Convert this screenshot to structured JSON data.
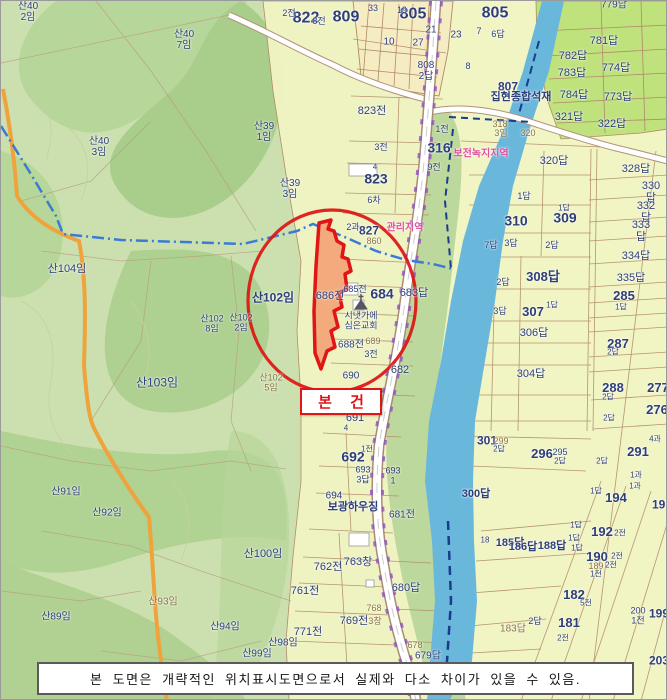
{
  "subject_box": {
    "label": "본 건"
  },
  "disclaimer": {
    "text": "본 도면은 개략적인 위치표시도면으로서 실제와 다소 차이가 있을 수 있음."
  },
  "landmarks": {
    "church": "시냇가에 심은교회",
    "business_1": "집현종합석재",
    "business_2": "보광하우징"
  },
  "zones": [
    "보전녹지지역",
    "관리지역"
  ],
  "subject_parcel": "686전",
  "colors": {
    "forest_light": "#cbe0ae",
    "forest_dark": "#abcf8d",
    "farmland": "#f1f4c3",
    "paddy_green": "#bfe27d",
    "cream": "#f6ecc2",
    "river": "#6ab7dc",
    "boundary": "#b08a68",
    "road_orange": "#efa33c",
    "label_navy": "#2e3f78",
    "label_olive": "#8a7440",
    "zone_pink": "#e0509f",
    "highlight_red": "#e01515",
    "subject_fill": "#f2a579"
  },
  "labels": [
    {
      "x": 27,
      "y": 12,
      "t": "산40\n2임",
      "c": "n",
      "s": 10
    },
    {
      "x": 305,
      "y": 17,
      "t": "822",
      "c": "b",
      "s": 16
    },
    {
      "x": 288,
      "y": 13,
      "t": "2전",
      "c": "n",
      "s": 9
    },
    {
      "x": 183,
      "y": 40,
      "t": "산40\n7임",
      "c": "n",
      "s": 10
    },
    {
      "x": 98,
      "y": 147,
      "t": "산40\n3임",
      "c": "n",
      "s": 10
    },
    {
      "x": 263,
      "y": 132,
      "t": "산39\n1임",
      "c": "n",
      "s": 10
    },
    {
      "x": 289,
      "y": 189,
      "t": "산39\n3임",
      "c": "n",
      "s": 10
    },
    {
      "x": 345,
      "y": 16,
      "t": "809",
      "c": "b",
      "s": 16
    },
    {
      "x": 372,
      "y": 8,
      "t": "33",
      "c": "n",
      "s": 9
    },
    {
      "x": 318,
      "y": 21,
      "t": "8전",
      "c": "n",
      "s": 9
    },
    {
      "x": 412,
      "y": 13,
      "t": "805",
      "c": "b",
      "s": 16
    },
    {
      "x": 494,
      "y": 12,
      "t": "805",
      "c": "b",
      "s": 16
    },
    {
      "x": 401,
      "y": 10,
      "t": "19",
      "c": "n",
      "s": 9
    },
    {
      "x": 430,
      "y": 30,
      "t": "21",
      "c": "n",
      "s": 10
    },
    {
      "x": 388,
      "y": 42,
      "t": "10",
      "c": "n",
      "s": 10
    },
    {
      "x": 417,
      "y": 43,
      "t": "27",
      "c": "n",
      "s": 10
    },
    {
      "x": 455,
      "y": 35,
      "t": "23",
      "c": "n",
      "s": 10
    },
    {
      "x": 425,
      "y": 71,
      "t": "808\n2답",
      "c": "n",
      "s": 10
    },
    {
      "x": 478,
      "y": 31,
      "t": "7",
      "c": "n",
      "s": 9
    },
    {
      "x": 497,
      "y": 34,
      "t": "6답",
      "c": "n",
      "s": 9
    },
    {
      "x": 467,
      "y": 66,
      "t": "8",
      "c": "n",
      "s": 9
    },
    {
      "x": 507,
      "y": 86,
      "t": "807",
      "c": "b",
      "s": 12
    },
    {
      "x": 520,
      "y": 97,
      "t": "집현종합석재",
      "c": "b",
      "s": 11
    },
    {
      "x": 613,
      "y": 5,
      "t": "779답",
      "c": "n",
      "s": 10
    },
    {
      "x": 603,
      "y": 41,
      "t": "781답",
      "c": "n",
      "s": 11
    },
    {
      "x": 572,
      "y": 56,
      "t": "782답",
      "c": "n",
      "s": 11
    },
    {
      "x": 615,
      "y": 68,
      "t": "774답",
      "c": "n",
      "s": 11
    },
    {
      "x": 571,
      "y": 73,
      "t": "783답",
      "c": "n",
      "s": 11
    },
    {
      "x": 573,
      "y": 95,
      "t": "784답",
      "c": "n",
      "s": 11
    },
    {
      "x": 617,
      "y": 97,
      "t": "773답",
      "c": "n",
      "s": 11
    },
    {
      "x": 568,
      "y": 117,
      "t": "321답",
      "c": "n",
      "s": 11
    },
    {
      "x": 611,
      "y": 124,
      "t": "322답",
      "c": "n",
      "s": 11
    },
    {
      "x": 499,
      "y": 124,
      "t": "318",
      "c": "o",
      "s": 9
    },
    {
      "x": 500,
      "y": 133,
      "t": "3임",
      "c": "o",
      "s": 9
    },
    {
      "x": 527,
      "y": 133,
      "t": "320",
      "c": "o",
      "s": 9
    },
    {
      "x": 438,
      "y": 147,
      "t": "316",
      "c": "b",
      "s": 14
    },
    {
      "x": 480,
      "y": 154,
      "t": "보전녹지지역",
      "c": "p",
      "s": 10
    },
    {
      "x": 441,
      "y": 129,
      "t": "1전",
      "c": "n",
      "s": 9
    },
    {
      "x": 433,
      "y": 167,
      "t": "9전",
      "c": "n",
      "s": 9
    },
    {
      "x": 371,
      "y": 111,
      "t": "823전",
      "c": "n",
      "s": 11
    },
    {
      "x": 380,
      "y": 147,
      "t": "3전",
      "c": "n",
      "s": 9
    },
    {
      "x": 374,
      "y": 167,
      "t": "4",
      "c": "n",
      "s": 8
    },
    {
      "x": 375,
      "y": 178,
      "t": "823",
      "c": "b",
      "s": 14
    },
    {
      "x": 373,
      "y": 200,
      "t": "6차",
      "c": "n",
      "s": 9
    },
    {
      "x": 352,
      "y": 227,
      "t": "2과",
      "c": "n",
      "s": 9
    },
    {
      "x": 368,
      "y": 230,
      "t": "827",
      "c": "b",
      "s": 12
    },
    {
      "x": 404,
      "y": 228,
      "t": "관리지역",
      "c": "p",
      "s": 10
    },
    {
      "x": 373,
      "y": 241,
      "t": "860",
      "c": "o",
      "s": 9
    },
    {
      "x": 553,
      "y": 161,
      "t": "320답",
      "c": "n",
      "s": 11
    },
    {
      "x": 635,
      "y": 169,
      "t": "328답",
      "c": "n",
      "s": 11
    },
    {
      "x": 523,
      "y": 196,
      "t": "1답",
      "c": "n",
      "s": 9
    },
    {
      "x": 650,
      "y": 192,
      "t": "330답",
      "c": "n",
      "s": 11
    },
    {
      "x": 515,
      "y": 220,
      "t": "310",
      "c": "b",
      "s": 14
    },
    {
      "x": 564,
      "y": 217,
      "t": "309",
      "c": "b",
      "s": 14
    },
    {
      "x": 563,
      "y": 208,
      "t": "1답",
      "c": "n",
      "s": 8
    },
    {
      "x": 645,
      "y": 212,
      "t": "332답",
      "c": "n",
      "s": 11
    },
    {
      "x": 640,
      "y": 231,
      "t": "333답",
      "c": "n",
      "s": 11
    },
    {
      "x": 490,
      "y": 245,
      "t": "7답",
      "c": "n",
      "s": 9
    },
    {
      "x": 510,
      "y": 243,
      "t": "3답",
      "c": "n",
      "s": 9
    },
    {
      "x": 551,
      "y": 245,
      "t": "2답",
      "c": "n",
      "s": 9
    },
    {
      "x": 635,
      "y": 256,
      "t": "334답",
      "c": "n",
      "s": 11
    },
    {
      "x": 630,
      "y": 278,
      "t": "335답",
      "c": "n",
      "s": 11
    },
    {
      "x": 502,
      "y": 282,
      "t": "2답",
      "c": "n",
      "s": 9
    },
    {
      "x": 542,
      "y": 276,
      "t": "308답",
      "c": "b",
      "s": 13
    },
    {
      "x": 499,
      "y": 311,
      "t": "3답",
      "c": "n",
      "s": 9
    },
    {
      "x": 532,
      "y": 311,
      "t": "307",
      "c": "b",
      "s": 13
    },
    {
      "x": 551,
      "y": 305,
      "t": "1답",
      "c": "n",
      "s": 8
    },
    {
      "x": 533,
      "y": 333,
      "t": "306답",
      "c": "n",
      "s": 11
    },
    {
      "x": 530,
      "y": 374,
      "t": "304답",
      "c": "n",
      "s": 11
    },
    {
      "x": 623,
      "y": 295,
      "t": "285",
      "c": "b",
      "s": 13
    },
    {
      "x": 620,
      "y": 307,
      "t": "1답",
      "c": "n",
      "s": 8
    },
    {
      "x": 617,
      "y": 343,
      "t": "287",
      "c": "b",
      "s": 13
    },
    {
      "x": 612,
      "y": 352,
      "t": "2답",
      "c": "n",
      "s": 8
    },
    {
      "x": 612,
      "y": 387,
      "t": "288",
      "c": "b",
      "s": 13
    },
    {
      "x": 607,
      "y": 397,
      "t": "2답",
      "c": "n",
      "s": 8
    },
    {
      "x": 657,
      "y": 387,
      "t": "277",
      "c": "b",
      "s": 13
    },
    {
      "x": 656,
      "y": 409,
      "t": "276",
      "c": "b",
      "s": 13
    },
    {
      "x": 608,
      "y": 418,
      "t": "2답",
      "c": "n",
      "s": 8
    },
    {
      "x": 654,
      "y": 439,
      "t": "4과",
      "c": "n",
      "s": 8
    },
    {
      "x": 637,
      "y": 451,
      "t": "291",
      "c": "b",
      "s": 13
    },
    {
      "x": 635,
      "y": 475,
      "t": "1과",
      "c": "n",
      "s": 8
    },
    {
      "x": 634,
      "y": 486,
      "t": "1과",
      "c": "n",
      "s": 8
    },
    {
      "x": 486,
      "y": 440,
      "t": "301",
      "c": "b",
      "s": 12
    },
    {
      "x": 500,
      "y": 441,
      "t": "299",
      "c": "o",
      "s": 9
    },
    {
      "x": 498,
      "y": 449,
      "t": "2답",
      "c": "n",
      "s": 8
    },
    {
      "x": 541,
      "y": 453,
      "t": "296",
      "c": "b",
      "s": 13
    },
    {
      "x": 559,
      "y": 452,
      "t": "295",
      "c": "n",
      "s": 9
    },
    {
      "x": 559,
      "y": 461,
      "t": "2답",
      "c": "n",
      "s": 8
    },
    {
      "x": 601,
      "y": 461,
      "t": "2답",
      "c": "n",
      "s": 8
    },
    {
      "x": 595,
      "y": 491,
      "t": "1답",
      "c": "n",
      "s": 8
    },
    {
      "x": 615,
      "y": 497,
      "t": "194",
      "c": "b",
      "s": 13
    },
    {
      "x": 661,
      "y": 504,
      "t": "195",
      "c": "b",
      "s": 12
    },
    {
      "x": 475,
      "y": 494,
      "t": "300답",
      "c": "b",
      "s": 11
    },
    {
      "x": 575,
      "y": 525,
      "t": "1답",
      "c": "n",
      "s": 8
    },
    {
      "x": 601,
      "y": 531,
      "t": "192",
      "c": "b",
      "s": 13
    },
    {
      "x": 619,
      "y": 533,
      "t": "2전",
      "c": "n",
      "s": 8
    },
    {
      "x": 573,
      "y": 538,
      "t": "1답",
      "c": "n",
      "s": 8
    },
    {
      "x": 484,
      "y": 540,
      "t": "18",
      "c": "n",
      "s": 8
    },
    {
      "x": 509,
      "y": 543,
      "t": "185답",
      "c": "b",
      "s": 11
    },
    {
      "x": 522,
      "y": 547,
      "t": "186답",
      "c": "b",
      "s": 11
    },
    {
      "x": 551,
      "y": 546,
      "t": "188답",
      "c": "b",
      "s": 11
    },
    {
      "x": 576,
      "y": 548,
      "t": "1답",
      "c": "n",
      "s": 8
    },
    {
      "x": 596,
      "y": 556,
      "t": "190",
      "c": "b",
      "s": 13
    },
    {
      "x": 616,
      "y": 556,
      "t": "2전",
      "c": "n",
      "s": 8
    },
    {
      "x": 595,
      "y": 566,
      "t": "189",
      "c": "o",
      "s": 9
    },
    {
      "x": 610,
      "y": 565,
      "t": "2전",
      "c": "n",
      "s": 8
    },
    {
      "x": 595,
      "y": 574,
      "t": "1전",
      "c": "n",
      "s": 8
    },
    {
      "x": 573,
      "y": 594,
      "t": "182",
      "c": "b",
      "s": 13
    },
    {
      "x": 585,
      "y": 603,
      "t": "5전",
      "c": "n",
      "s": 8
    },
    {
      "x": 637,
      "y": 615,
      "t": "200\n1전",
      "c": "n",
      "s": 9
    },
    {
      "x": 658,
      "y": 613,
      "t": "199",
      "c": "b",
      "s": 12
    },
    {
      "x": 568,
      "y": 622,
      "t": "181",
      "c": "b",
      "s": 13
    },
    {
      "x": 534,
      "y": 621,
      "t": "2답",
      "c": "n",
      "s": 9
    },
    {
      "x": 512,
      "y": 629,
      "t": "183답",
      "c": "o",
      "s": 10
    },
    {
      "x": 562,
      "y": 638,
      "t": "2전",
      "c": "n",
      "s": 8
    },
    {
      "x": 658,
      "y": 660,
      "t": "203",
      "c": "b",
      "s": 12
    },
    {
      "x": 329,
      "y": 296,
      "t": "686전",
      "c": "n",
      "s": 11
    },
    {
      "x": 354,
      "y": 289,
      "t": "685전",
      "c": "n",
      "s": 9
    },
    {
      "x": 381,
      "y": 293,
      "t": "684",
      "c": "b",
      "s": 14
    },
    {
      "x": 413,
      "y": 293,
      "t": "683답",
      "c": "n",
      "s": 11
    },
    {
      "x": 360,
      "y": 320,
      "t": "시냇가에\n심은교회",
      "c": "n",
      "s": 9
    },
    {
      "x": 350,
      "y": 345,
      "t": "688전",
      "c": "n",
      "s": 10
    },
    {
      "x": 372,
      "y": 341,
      "t": "689",
      "c": "o",
      "s": 9
    },
    {
      "x": 370,
      "y": 354,
      "t": "3전",
      "c": "n",
      "s": 9
    },
    {
      "x": 350,
      "y": 376,
      "t": "690",
      "c": "n",
      "s": 10
    },
    {
      "x": 399,
      "y": 370,
      "t": "682",
      "c": "n",
      "s": 11
    },
    {
      "x": 354,
      "y": 418,
      "t": "691",
      "c": "n",
      "s": 11
    },
    {
      "x": 345,
      "y": 428,
      "t": "4",
      "c": "n",
      "s": 8
    },
    {
      "x": 352,
      "y": 456,
      "t": "692",
      "c": "b",
      "s": 14
    },
    {
      "x": 366,
      "y": 449,
      "t": "1전",
      "c": "n",
      "s": 8
    },
    {
      "x": 362,
      "y": 474,
      "t": "693\n3답",
      "c": "n",
      "s": 9
    },
    {
      "x": 392,
      "y": 475,
      "t": "693\n1",
      "c": "n",
      "s": 9
    },
    {
      "x": 333,
      "y": 496,
      "t": "694",
      "c": "n",
      "s": 10
    },
    {
      "x": 352,
      "y": 507,
      "t": "보광하우징",
      "c": "b",
      "s": 11
    },
    {
      "x": 401,
      "y": 515,
      "t": "681전",
      "c": "n",
      "s": 10
    },
    {
      "x": 327,
      "y": 567,
      "t": "762전",
      "c": "n",
      "s": 11
    },
    {
      "x": 357,
      "y": 562,
      "t": "763창",
      "c": "n",
      "s": 11
    },
    {
      "x": 304,
      "y": 591,
      "t": "761전",
      "c": "n",
      "s": 11
    },
    {
      "x": 405,
      "y": 588,
      "t": "680답",
      "c": "n",
      "s": 11
    },
    {
      "x": 373,
      "y": 608,
      "t": "768",
      "c": "o",
      "s": 9
    },
    {
      "x": 353,
      "y": 621,
      "t": "769전",
      "c": "n",
      "s": 11
    },
    {
      "x": 374,
      "y": 621,
      "t": "3창",
      "c": "o",
      "s": 9
    },
    {
      "x": 307,
      "y": 632,
      "t": "771전",
      "c": "n",
      "s": 11
    },
    {
      "x": 414,
      "y": 645,
      "t": "678",
      "c": "o",
      "s": 9
    },
    {
      "x": 427,
      "y": 656,
      "t": "679답",
      "c": "n",
      "s": 10
    },
    {
      "x": 262,
      "y": 554,
      "t": "산100임",
      "c": "n",
      "s": 11
    },
    {
      "x": 282,
      "y": 643,
      "t": "산98임",
      "c": "n",
      "s": 10
    },
    {
      "x": 256,
      "y": 654,
      "t": "산99임",
      "c": "n",
      "s": 10
    },
    {
      "x": 66,
      "y": 269,
      "t": "산104임",
      "c": "n",
      "s": 11
    },
    {
      "x": 272,
      "y": 297,
      "t": "산102임",
      "c": "b",
      "s": 12
    },
    {
      "x": 211,
      "y": 323,
      "t": "산102\n8임",
      "c": "n",
      "s": 9
    },
    {
      "x": 240,
      "y": 322,
      "t": "산102\n2임",
      "c": "n",
      "s": 9
    },
    {
      "x": 270,
      "y": 382,
      "t": "산102\n5임",
      "c": "o",
      "s": 9
    },
    {
      "x": 156,
      "y": 382,
      "t": "산103임",
      "c": "n",
      "s": 12
    },
    {
      "x": 65,
      "y": 492,
      "t": "산91임",
      "c": "n",
      "s": 10
    },
    {
      "x": 106,
      "y": 513,
      "t": "산92임",
      "c": "n",
      "s": 10
    },
    {
      "x": 55,
      "y": 617,
      "t": "산89임",
      "c": "n",
      "s": 10
    },
    {
      "x": 162,
      "y": 602,
      "t": "산93임",
      "c": "o",
      "s": 10
    },
    {
      "x": 224,
      "y": 627,
      "t": "산94임",
      "c": "n",
      "s": 10
    }
  ]
}
